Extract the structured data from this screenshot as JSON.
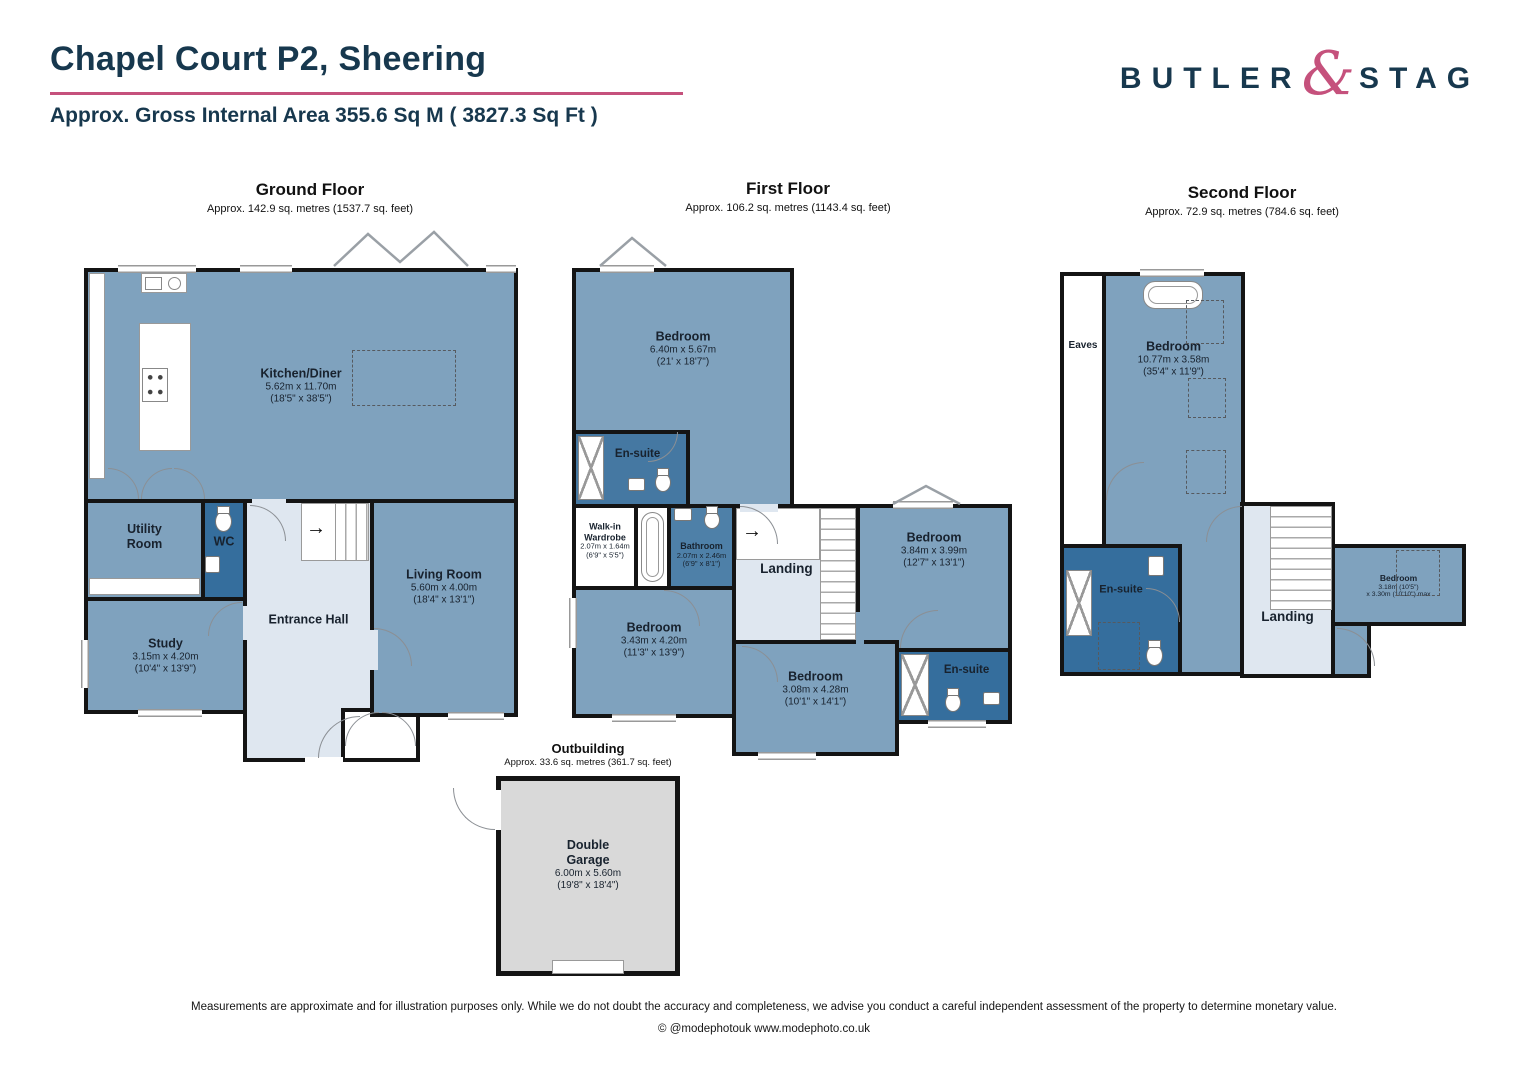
{
  "header": {
    "title": "Chapel Court P2, Sheering",
    "subtitle": "Approx. Gross Internal Area  355.6 Sq M ( 3827.3 Sq Ft )"
  },
  "logo": {
    "butler": "BUTLER",
    "ampersand": "&",
    "stag": "STAG"
  },
  "colors": {
    "navy": "#17384E",
    "pink": "#C5517C",
    "wall": "#141414",
    "roomBlue": "#7FA2BE",
    "roomLight": "#DFE7F0",
    "roomDark": "#356E9D",
    "midBlue": "#4E80A8",
    "ensuiteBlue": "#4578A2",
    "garageGray": "#D9D9D9"
  },
  "floors": {
    "ground": {
      "title": "Ground Floor",
      "area": "Approx. 142.9 sq. metres (1537.7 sq. feet)",
      "rooms": {
        "kitchen": {
          "name": "Kitchen/Diner",
          "m": "5.62m x 11.70m",
          "ft": "(18'5\" x 38'5\")"
        },
        "utility": {
          "name": "Utility Room"
        },
        "wc": {
          "name": "WC"
        },
        "study": {
          "name": "Study",
          "m": "3.15m x 4.20m",
          "ft": "(10'4\" x 13'9\")"
        },
        "hall": {
          "name": "Entrance Hall"
        },
        "living": {
          "name": "Living Room",
          "m": "5.60m x 4.00m",
          "ft": "(18'4\" x 13'1\")"
        }
      }
    },
    "first": {
      "title": "First Floor",
      "area": "Approx. 106.2 sq. metres (1143.4 sq. feet)",
      "rooms": {
        "bed1": {
          "name": "Bedroom",
          "m": "6.40m x 5.67m",
          "ft": "(21' x 18'7\")"
        },
        "ensuite1": {
          "name": "En-suite"
        },
        "wardrobe": {
          "name": "Walk-in Wardrobe",
          "m": "2.07m x 1.64m",
          "ft": "(6'9\" x 5'5\")"
        },
        "bathroom": {
          "name": "Bathroom",
          "m": "2.07m x 2.46m",
          "ft": "(6'9\" x 8'1\")"
        },
        "landing": {
          "name": "Landing"
        },
        "bed2": {
          "name": "Bedroom",
          "m": "3.84m x 3.99m",
          "ft": "(12'7\" x 13'1\")"
        },
        "bed3": {
          "name": "Bedroom",
          "m": "3.43m x 4.20m",
          "ft": "(11'3\" x 13'9\")"
        },
        "bed4": {
          "name": "Bedroom",
          "m": "3.08m x 4.28m",
          "ft": "(10'1\" x 14'1\")"
        },
        "ensuite2": {
          "name": "En-suite"
        }
      }
    },
    "second": {
      "title": "Second Floor",
      "area": "Approx. 72.9 sq. metres (784.6 sq. feet)",
      "rooms": {
        "eaves": {
          "name": "Eaves"
        },
        "bed5": {
          "name": "Bedroom",
          "m": "10.77m x 3.58m",
          "ft": "(35'4\" x 11'9\")"
        },
        "ensuite3": {
          "name": "En-suite"
        },
        "landing": {
          "name": "Landing"
        },
        "bed6": {
          "name": "Bedroom",
          "m": "3.18m (10'5\")",
          "ft": "x 3.30m (10'10\") max"
        }
      }
    }
  },
  "outbuilding": {
    "title": "Outbuilding",
    "area": "Approx. 33.6 sq. metres (361.7 sq. feet)",
    "rooms": {
      "garage": {
        "name": "Double Garage",
        "m": "6.00m x 5.60m",
        "ft": "(19'8\" x 18'4\")"
      }
    }
  },
  "footer": {
    "disclaimer": "Measurements are approximate and for illustration purposes only.  While we do not doubt the accuracy and completeness, we advise you conduct a careful independent assessment of the property to determine monetary value.",
    "credit": "© @modephotouk www.modephoto.co.uk"
  }
}
